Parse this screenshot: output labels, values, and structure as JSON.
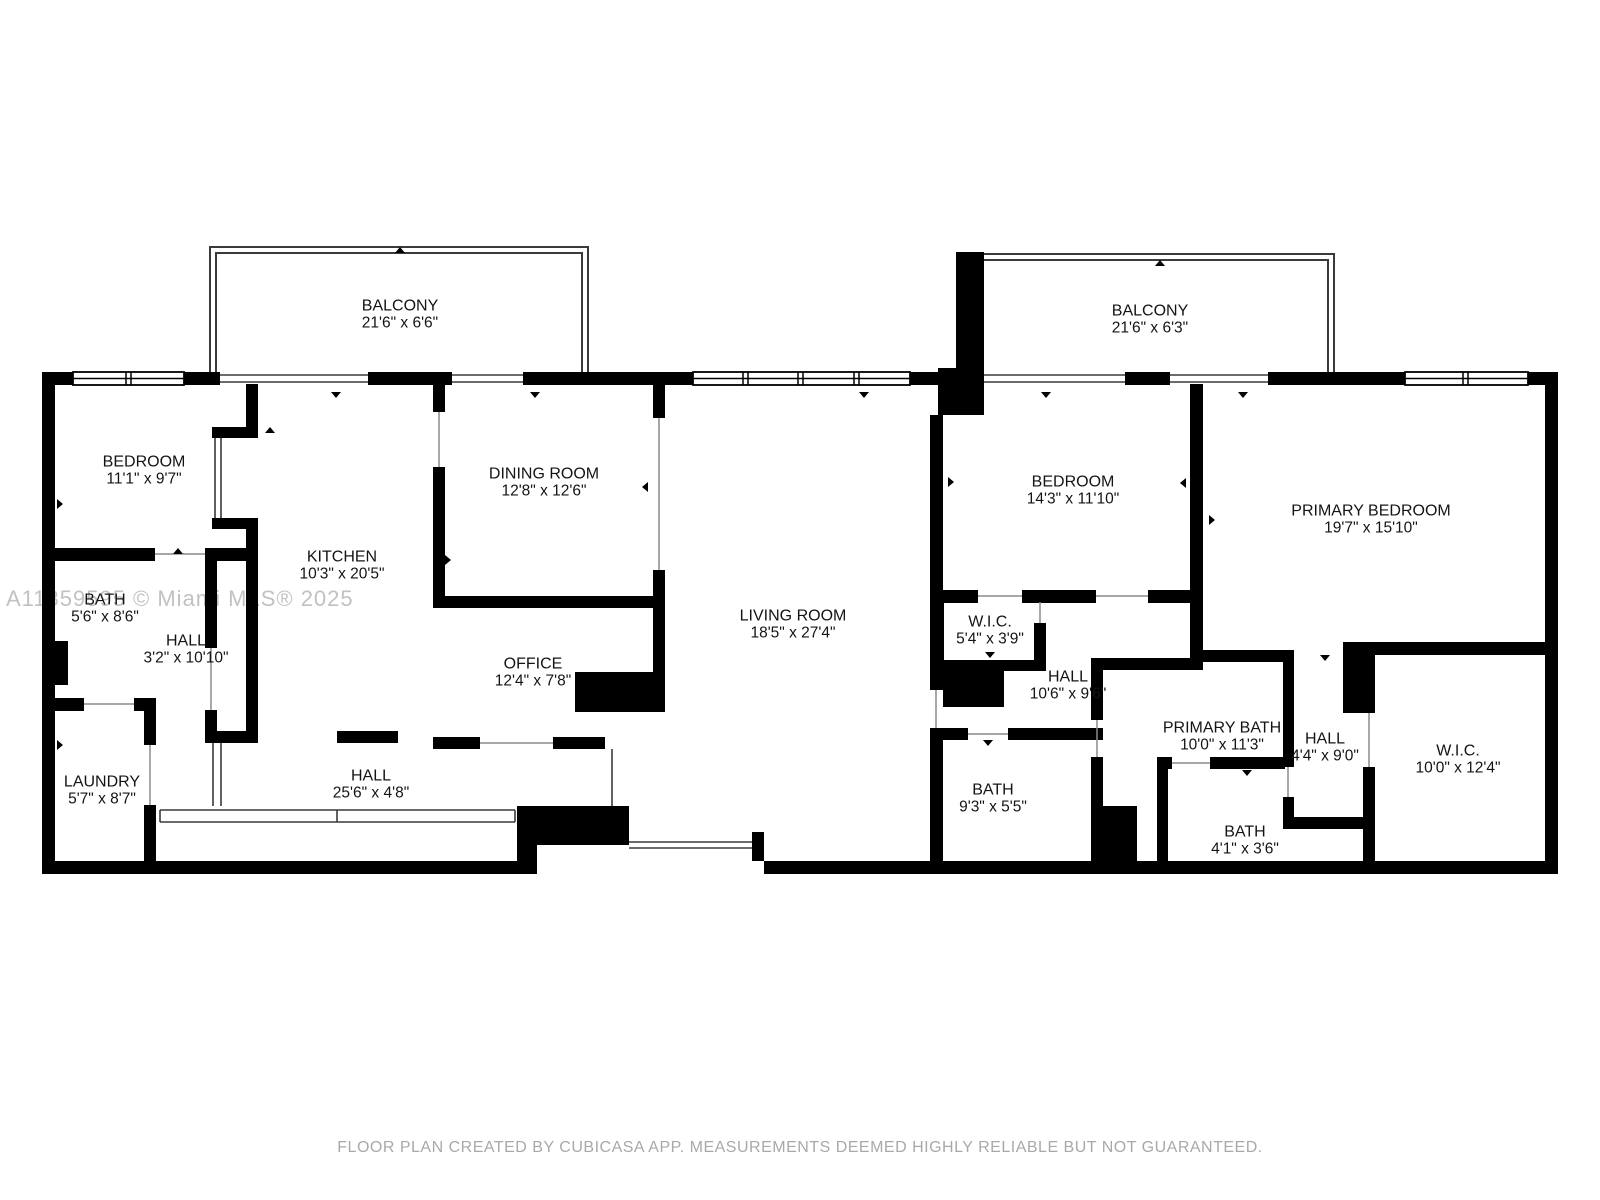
{
  "watermark": "A11359595 © Miami MLS® 2025",
  "footer": "FLOOR PLAN CREATED BY CUBICASA APP. MEASUREMENTS DEEMED HIGHLY RELIABLE BUT NOT GUARANTEED.",
  "colors": {
    "wall": "#000000",
    "label": "#141414",
    "watermark": "#8f8f8f",
    "footer": "#a9a9a9",
    "thin_line": "#3a3a3a"
  },
  "rooms": [
    {
      "id": "balcony-left",
      "name": "BALCONY",
      "dims": "21'6\" x 6'6\""
    },
    {
      "id": "bedroom-left",
      "name": "BEDROOM",
      "dims": "11'1\" x 9'7\""
    },
    {
      "id": "dining-room",
      "name": "DINING ROOM",
      "dims": "12'8\" x 12'6\""
    },
    {
      "id": "kitchen",
      "name": "KITCHEN",
      "dims": "10'3\" x 20'5\""
    },
    {
      "id": "office",
      "name": "OFFICE",
      "dims": "12'4\" x 7'8\""
    },
    {
      "id": "living-room",
      "name": "LIVING ROOM",
      "dims": "18'5\" x 27'4\""
    },
    {
      "id": "balcony-right",
      "name": "BALCONY",
      "dims": "21'6\" x 6'3\""
    },
    {
      "id": "bedroom-right",
      "name": "BEDROOM",
      "dims": "14'3\" x 11'10\""
    },
    {
      "id": "primary-bedroom",
      "name": "PRIMARY BEDROOM",
      "dims": "19'7\" x 15'10\""
    },
    {
      "id": "wic-small",
      "name": "W.I.C.",
      "dims": "5'4\" x 3'9\""
    },
    {
      "id": "hall-right",
      "name": "HALL",
      "dims": "10'6\" x 9'6\""
    },
    {
      "id": "primary-bath",
      "name": "PRIMARY BATH",
      "dims": "10'0\" x 11'3\""
    },
    {
      "id": "hall-small",
      "name": "HALL",
      "dims": "4'4\" x 9'0\""
    },
    {
      "id": "wic-big",
      "name": "W.I.C.",
      "dims": "10'0\" x 12'4\""
    },
    {
      "id": "bath-mid",
      "name": "BATH",
      "dims": "9'3\" x 5'5\""
    },
    {
      "id": "bath-small",
      "name": "BATH",
      "dims": "4'1\" x 3'6\""
    },
    {
      "id": "bath-left",
      "name": "BATH",
      "dims": "5'6\" x 8'6\""
    },
    {
      "id": "hall-left",
      "name": "HALL",
      "dims": "3'2\" x 10'10\""
    },
    {
      "id": "laundry",
      "name": "LAUNDRY",
      "dims": "5'7\" x 8'7\""
    },
    {
      "id": "hall-bottom",
      "name": "HALL",
      "dims": "25'6\" x 4'8\""
    }
  ]
}
